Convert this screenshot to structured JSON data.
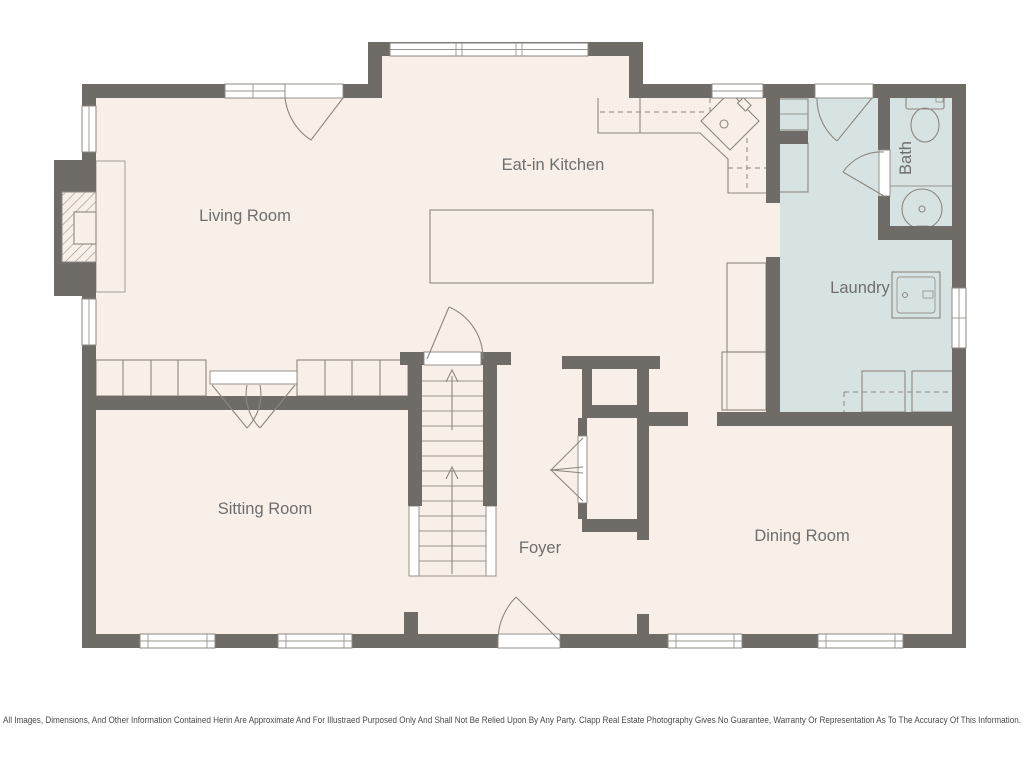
{
  "plan": {
    "colors": {
      "wall": "#6f6b67",
      "floor": "#f7efe8",
      "wet_room_floor": "#d6e3e2",
      "line": "#8d8780",
      "label_text": "#6e6e6e"
    },
    "rooms": {
      "living": "Living Room",
      "kitchen": "Eat-in Kitchen",
      "bath": "Bath",
      "laundry": "Laundry",
      "sitting": "Sitting Room",
      "foyer": "Foyer",
      "dining": "Dining Room"
    },
    "disclaimer": "All Images, Dimensions, And Other Information Contained Herin Are Approximate And For Illustraed Purposed Only And Shall Not Be Relied Upon By Any Party. Clapp Real Estate Photography Gives No Guarantee, Warranty Or Representation As To The Accuracy Of This Information."
  }
}
